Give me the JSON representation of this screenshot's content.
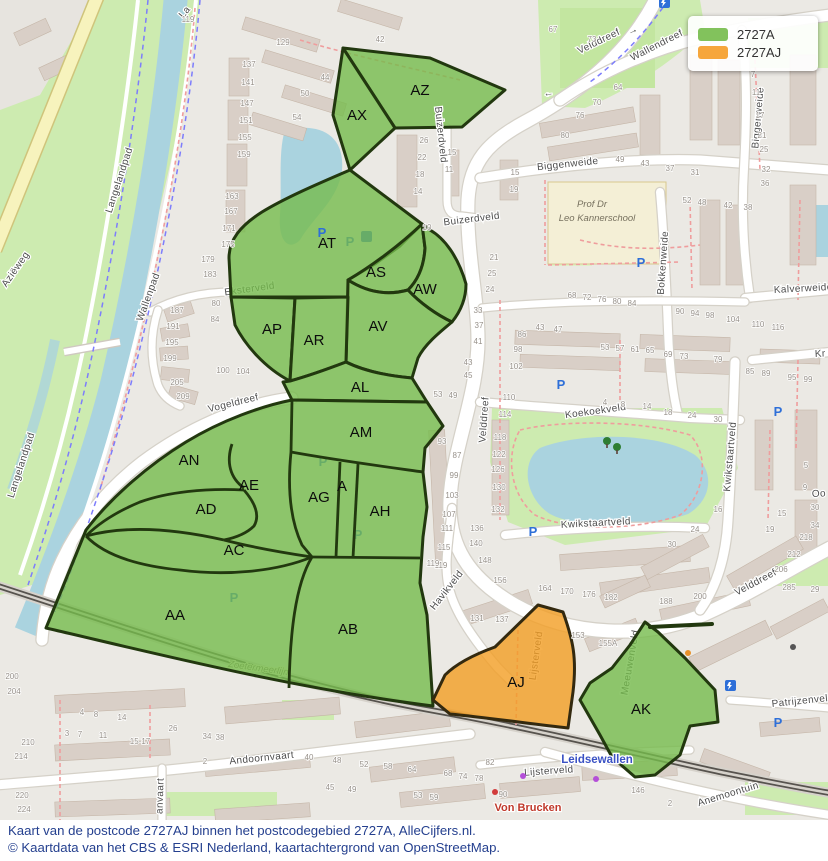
{
  "legend": {
    "items": [
      {
        "label": "2727A",
        "color": "#82c25c"
      },
      {
        "label": "2727AJ",
        "color": "#f6a63c"
      }
    ]
  },
  "caption": {
    "line1": "Kaart van de postcode 2727AJ binnen het postcodegebied 2727A, AlleCijfers.nl.",
    "line2": "© Kaartdata van het CBS & ESRI Nederland, kaartachtergrond van OpenStreetMap."
  },
  "map": {
    "colors": {
      "region_green_fill": "rgba(118,188,76,0.8)",
      "region_orange_fill": "rgba(243,158,35,0.8)",
      "region_stroke": "#22380f",
      "park": "#cdebb0",
      "water": "#aad3df",
      "building": "#d9cfc7"
    },
    "region_labels": [
      {
        "code": "AZ",
        "x": 420,
        "y": 95
      },
      {
        "code": "AX",
        "x": 357,
        "y": 120
      },
      {
        "code": "AT",
        "x": 327,
        "y": 248
      },
      {
        "code": "AS",
        "x": 376,
        "y": 277
      },
      {
        "code": "AW",
        "x": 425,
        "y": 294
      },
      {
        "code": "AP",
        "x": 272,
        "y": 334
      },
      {
        "code": "AR",
        "x": 314,
        "y": 345
      },
      {
        "code": "AV",
        "x": 378,
        "y": 331
      },
      {
        "code": "AL",
        "x": 360,
        "y": 392
      },
      {
        "code": "AM",
        "x": 361,
        "y": 437
      },
      {
        "code": "AN",
        "x": 189,
        "y": 465
      },
      {
        "code": "AE",
        "x": 249,
        "y": 490
      },
      {
        "code": "AD",
        "x": 206,
        "y": 514
      },
      {
        "code": "AG",
        "x": 319,
        "y": 502
      },
      {
        "code": "A",
        "x": 342,
        "y": 491
      },
      {
        "code": "AH",
        "x": 380,
        "y": 516
      },
      {
        "code": "AC",
        "x": 234,
        "y": 555
      },
      {
        "code": "AA",
        "x": 175,
        "y": 620
      },
      {
        "code": "AB",
        "x": 348,
        "y": 634
      },
      {
        "code": "AJ",
        "x": 516,
        "y": 687
      },
      {
        "code": "AK",
        "x": 641,
        "y": 714
      }
    ],
    "street_labels": [
      {
        "t": "Velddreef",
        "x": 600,
        "y": 44,
        "r": -26
      },
      {
        "t": "→",
        "x": 634,
        "y": 33,
        "r": -25
      },
      {
        "t": "←",
        "x": 549,
        "y": 96,
        "r": -8
      },
      {
        "t": "Wallendreef",
        "x": 658,
        "y": 48,
        "r": -27
      },
      {
        "t": "Biggenweide",
        "x": 568,
        "y": 167,
        "r": -6
      },
      {
        "t": "Biggenweide",
        "x": 761,
        "y": 118,
        "r": -85
      },
      {
        "t": "Bokkenweide",
        "x": 666,
        "y": 263,
        "r": -86
      },
      {
        "t": "Buizerdveld",
        "x": 472,
        "y": 222,
        "r": -7
      },
      {
        "t": "Buizerdveld",
        "x": 438,
        "y": 135,
        "r": 84
      },
      {
        "t": "Velddreef",
        "x": 487,
        "y": 420,
        "r": -86
      },
      {
        "t": "Velddreef",
        "x": 757,
        "y": 585,
        "r": -28
      },
      {
        "t": "Kalverweide",
        "x": 774,
        "y": 293,
        "r": -3,
        "a": "s"
      },
      {
        "t": "Kr",
        "x": 815,
        "y": 357,
        "r": -3,
        "a": "s"
      },
      {
        "t": "Koekoekveld",
        "x": 596,
        "y": 414,
        "r": -8
      },
      {
        "t": "Kwikstaartveld",
        "x": 596,
        "y": 526,
        "r": -3
      },
      {
        "t": "Kwikstaartveld",
        "x": 733,
        "y": 457,
        "r": -85
      },
      {
        "t": "Oo",
        "x": 812,
        "y": 497,
        "r": -3,
        "a": "s"
      },
      {
        "t": "Vogeldreef",
        "x": 234,
        "y": 406,
        "r": -14
      },
      {
        "t": "Eksterveld",
        "x": 250,
        "y": 292,
        "r": -8,
        "u": 1
      },
      {
        "t": "Havikveld",
        "x": 449,
        "y": 592,
        "r": -52
      },
      {
        "t": "Lijsterveld",
        "x": 549,
        "y": 774,
        "r": -4
      },
      {
        "t": "Lijsterveld",
        "x": 539,
        "y": 656,
        "r": -82,
        "u": 1
      },
      {
        "t": "Meeuwenveld",
        "x": 633,
        "y": 663,
        "r": -80,
        "u": 1
      },
      {
        "t": "Leidsewallen",
        "x": 597,
        "y": 763,
        "k": "station"
      },
      {
        "t": "Von Brucken",
        "x": 528,
        "y": 811,
        "k": "red"
      },
      {
        "t": "Anemoontuin",
        "x": 729,
        "y": 797,
        "r": -17
      },
      {
        "t": "Andoornvaart",
        "x": 262,
        "y": 761,
        "r": -6
      },
      {
        "t": "anvaart",
        "x": 163,
        "y": 796,
        "r": -88
      },
      {
        "t": "Patrijzenveld",
        "x": 772,
        "y": 707,
        "r": -6,
        "a": "s"
      },
      {
        "t": "Wallenpad",
        "x": 151,
        "y": 298,
        "r": -70
      },
      {
        "t": "Langelandpad",
        "x": 122,
        "y": 181,
        "r": -72
      },
      {
        "t": "Langelandpad",
        "x": 24,
        "y": 466,
        "r": -72
      },
      {
        "t": "Aziëweg",
        "x": 18,
        "y": 271,
        "r": -55
      },
      {
        "t": "La",
        "x": 187,
        "y": 14,
        "r": -50
      },
      {
        "t": "Zoetermeerlijn",
        "x": 258,
        "y": 671,
        "r": 8,
        "u": 1,
        "k": "school"
      },
      {
        "t": "Prof Dr",
        "x": 592,
        "y": 207,
        "k": "school"
      },
      {
        "t": "Leo Kannerschool",
        "x": 597,
        "y": 221,
        "k": "school"
      }
    ],
    "house_numbers": [
      [
        "137",
        249,
        67
      ],
      [
        "141",
        248,
        85
      ],
      [
        "147",
        247,
        106
      ],
      [
        "151",
        246,
        123
      ],
      [
        "155",
        245,
        140
      ],
      [
        "159",
        244,
        157
      ],
      [
        "163",
        232,
        199
      ],
      [
        "167",
        231,
        214
      ],
      [
        "171",
        229,
        231
      ],
      [
        "175",
        228,
        247
      ],
      [
        "179",
        208,
        262
      ],
      [
        "183",
        210,
        277
      ],
      [
        "187",
        177,
        313
      ],
      [
        "191",
        173,
        329
      ],
      [
        "195",
        172,
        345
      ],
      [
        "199",
        170,
        361
      ],
      [
        "205",
        177,
        385
      ],
      [
        "209",
        183,
        399
      ],
      [
        "80",
        216,
        306
      ],
      [
        "84",
        215,
        322
      ],
      [
        "100",
        223,
        373
      ],
      [
        "104",
        243,
        374
      ],
      [
        "119",
        188,
        22
      ],
      [
        "129",
        283,
        45
      ],
      [
        "42",
        380,
        42
      ],
      [
        "44",
        325,
        80
      ],
      [
        "50",
        305,
        96
      ],
      [
        "54",
        297,
        120
      ],
      [
        "26",
        424,
        143
      ],
      [
        "22",
        422,
        160
      ],
      [
        "18",
        420,
        177
      ],
      [
        "14",
        418,
        194
      ],
      [
        "10",
        427,
        230
      ],
      [
        "15",
        452,
        155
      ],
      [
        "11",
        449,
        172
      ],
      [
        "15",
        515,
        175
      ],
      [
        "19",
        514,
        192
      ],
      [
        "21",
        494,
        260
      ],
      [
        "25",
        492,
        276
      ],
      [
        "24",
        490,
        292
      ],
      [
        "67",
        553,
        32
      ],
      [
        "73",
        592,
        42
      ],
      [
        "64",
        618,
        90
      ],
      [
        "70",
        597,
        105
      ],
      [
        "76",
        580,
        118
      ],
      [
        "80",
        565,
        138
      ],
      [
        "49",
        620,
        162
      ],
      [
        "43",
        645,
        166
      ],
      [
        "37",
        670,
        171
      ],
      [
        "31",
        695,
        175
      ],
      [
        "7",
        753,
        77
      ],
      [
        "11",
        756,
        95
      ],
      [
        "17",
        760,
        118
      ],
      [
        "21",
        762,
        138
      ],
      [
        "25",
        764,
        152
      ],
      [
        "32",
        766,
        172
      ],
      [
        "36",
        765,
        186
      ],
      [
        "52",
        687,
        203
      ],
      [
        "48",
        702,
        205
      ],
      [
        "42",
        728,
        208
      ],
      [
        "38",
        748,
        210
      ],
      [
        "68",
        572,
        298
      ],
      [
        "72",
        587,
        300
      ],
      [
        "76",
        602,
        302
      ],
      [
        "80",
        617,
        304
      ],
      [
        "84",
        632,
        306
      ],
      [
        "90",
        680,
        314
      ],
      [
        "94",
        695,
        316
      ],
      [
        "98",
        710,
        318
      ],
      [
        "104",
        733,
        322
      ],
      [
        "110",
        758,
        327
      ],
      [
        "116",
        778,
        330
      ],
      [
        "43",
        540,
        330
      ],
      [
        "47",
        558,
        332
      ],
      [
        "86",
        522,
        337
      ],
      [
        "98",
        518,
        352
      ],
      [
        "102",
        516,
        369
      ],
      [
        "110",
        509,
        400
      ],
      [
        "114",
        505,
        417
      ],
      [
        "118",
        500,
        440
      ],
      [
        "122",
        499,
        457
      ],
      [
        "126",
        498,
        472
      ],
      [
        "130",
        499,
        490
      ],
      [
        "132",
        498,
        512
      ],
      [
        "53",
        605,
        350
      ],
      [
        "57",
        620,
        351
      ],
      [
        "61",
        635,
        352
      ],
      [
        "65",
        650,
        353
      ],
      [
        "69",
        668,
        357
      ],
      [
        "73",
        684,
        359
      ],
      [
        "79",
        718,
        362
      ],
      [
        "85",
        750,
        374
      ],
      [
        "89",
        766,
        376
      ],
      [
        "95",
        792,
        380
      ],
      [
        "99",
        808,
        382
      ],
      [
        "4",
        605,
        405
      ],
      [
        "8",
        623,
        407
      ],
      [
        "14",
        647,
        409
      ],
      [
        "18",
        668,
        415
      ],
      [
        "24",
        692,
        418
      ],
      [
        "30",
        718,
        422
      ],
      [
        "16",
        718,
        512
      ],
      [
        "24",
        695,
        532
      ],
      [
        "30",
        672,
        547
      ],
      [
        "15",
        782,
        516
      ],
      [
        "19",
        770,
        532
      ],
      [
        "30",
        815,
        510
      ],
      [
        "34",
        815,
        528
      ],
      [
        "5",
        806,
        468
      ],
      [
        "9",
        805,
        490
      ],
      [
        "93",
        442,
        444
      ],
      [
        "87",
        457,
        458
      ],
      [
        "99",
        454,
        478
      ],
      [
        "103",
        452,
        498
      ],
      [
        "107",
        449,
        517
      ],
      [
        "111",
        447,
        531
      ],
      [
        "115",
        444,
        550
      ],
      [
        "119",
        441,
        568
      ],
      [
        "53",
        438,
        397
      ],
      [
        "49",
        453,
        398
      ],
      [
        "43",
        468,
        365
      ],
      [
        "45",
        468,
        378
      ],
      [
        "41",
        478,
        344
      ],
      [
        "37",
        479,
        328
      ],
      [
        "33",
        478,
        313
      ],
      [
        "136",
        477,
        531
      ],
      [
        "140",
        476,
        546
      ],
      [
        "148",
        485,
        563
      ],
      [
        "156",
        500,
        583
      ],
      [
        "164",
        545,
        591
      ],
      [
        "170",
        567,
        594
      ],
      [
        "176",
        589,
        597
      ],
      [
        "182",
        611,
        600
      ],
      [
        "188",
        666,
        604
      ],
      [
        "200",
        700,
        599
      ],
      [
        "206",
        781,
        572
      ],
      [
        "212",
        794,
        557
      ],
      [
        "218",
        806,
        540
      ],
      [
        "285",
        789,
        590
      ],
      [
        "29",
        815,
        592
      ],
      [
        "153",
        578,
        638
      ],
      [
        "155A",
        608,
        646
      ],
      [
        "146",
        638,
        793
      ],
      [
        "90",
        503,
        797
      ],
      [
        "2",
        670,
        806
      ],
      [
        "82",
        490,
        765
      ],
      [
        "68",
        448,
        776
      ],
      [
        "74",
        463,
        779
      ],
      [
        "78",
        479,
        781
      ],
      [
        "64",
        412,
        772
      ],
      [
        "58",
        388,
        769
      ],
      [
        "52",
        364,
        767
      ],
      [
        "48",
        337,
        763
      ],
      [
        "40",
        309,
        760
      ],
      [
        "45",
        330,
        790
      ],
      [
        "49",
        352,
        792
      ],
      [
        "53",
        418,
        798
      ],
      [
        "59",
        434,
        800
      ],
      [
        "3",
        67,
        736
      ],
      [
        "7",
        80,
        737
      ],
      [
        "11",
        103,
        738
      ],
      [
        "15-17",
        140,
        744
      ],
      [
        "26",
        173,
        731
      ],
      [
        "34",
        207,
        739
      ],
      [
        "38",
        220,
        740
      ],
      [
        "4",
        82,
        715
      ],
      [
        "8",
        96,
        717
      ],
      [
        "14",
        122,
        720
      ],
      [
        "2",
        205,
        764
      ],
      [
        "200",
        12,
        679
      ],
      [
        "204",
        14,
        694
      ],
      [
        "210",
        28,
        745
      ],
      [
        "214",
        21,
        759
      ],
      [
        "220",
        22,
        798
      ],
      [
        "224",
        24,
        812
      ],
      [
        "131",
        477,
        621
      ],
      [
        "137",
        502,
        622
      ],
      [
        "119",
        433,
        566
      ]
    ],
    "pois": {
      "parking_glyph": "P",
      "parking": [
        {
          "x": 322,
          "y": 237
        },
        {
          "x": 641,
          "y": 267
        },
        {
          "x": 561,
          "y": 389
        },
        {
          "x": 778,
          "y": 416
        },
        {
          "x": 533,
          "y": 536
        },
        {
          "x": 778,
          "y": 727
        },
        {
          "x": 350,
          "y": 246,
          "u": 1
        },
        {
          "x": 234,
          "y": 602,
          "u": 1,
          "s": 17
        },
        {
          "x": 323,
          "y": 466,
          "u": 1
        },
        {
          "x": 358,
          "y": 539,
          "u": 1
        }
      ],
      "markers": [
        {
          "x": 366,
          "y": 236,
          "c": "#2e6fd8",
          "u": 1
        },
        {
          "x": 730,
          "y": 685,
          "c": "#2e6fd8"
        },
        {
          "x": 664,
          "y": 2,
          "c": "#2e6fd8"
        }
      ],
      "dots": [
        {
          "x": 688,
          "y": 653,
          "c": "#e8912a"
        },
        {
          "x": 523,
          "y": 776,
          "c": "#b44fd8"
        },
        {
          "x": 596,
          "y": 779,
          "c": "#b44fd8"
        },
        {
          "x": 495,
          "y": 792,
          "c": "#d23c3c"
        },
        {
          "x": 793,
          "y": 647,
          "c": "#555555"
        }
      ],
      "trees": [
        {
          "x": 607,
          "y": 441
        },
        {
          "x": 617,
          "y": 447
        }
      ]
    }
  }
}
